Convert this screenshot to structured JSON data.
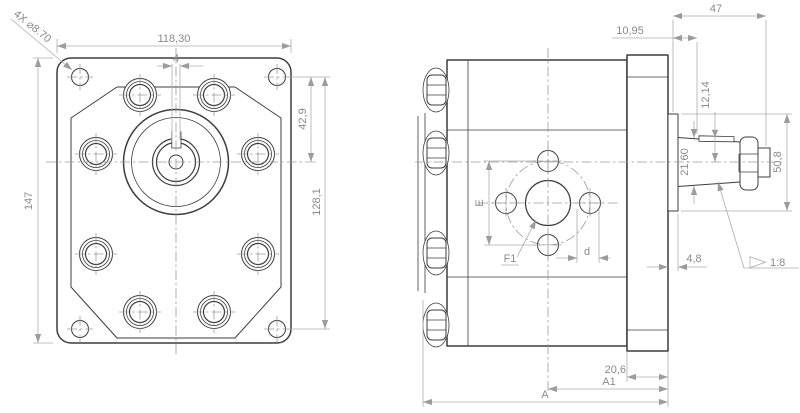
{
  "drawing": {
    "front_view": {
      "bolt_callout": "4X ⌀8.70",
      "flange_width": "118,30",
      "keyway_width": "4",
      "hole_to_shaft_center": "42,9",
      "hole_vertical_spacing": "128,1",
      "flange_height": "147"
    },
    "side_view": {
      "shaft_end_length": "47",
      "boss_to_key": "10,95",
      "key_to_center": "12,14",
      "taper_diameter": "21,60",
      "pilot_diameter": "50,8",
      "pilot_thickness": "4,8",
      "taper_ratio": "1:8",
      "port_bolt_spacing_label": "E",
      "port_label": "F1",
      "port_hole_label": "d",
      "rear_cover_thickness": "20,6",
      "length_a1_label": "A1",
      "length_a_label": "A"
    },
    "style": {
      "geometry_line_color": "#3d3d3d",
      "dimension_line_color": "#acacac",
      "dimension_text_color": "#8a8a8a",
      "background": "#ffffff"
    }
  }
}
